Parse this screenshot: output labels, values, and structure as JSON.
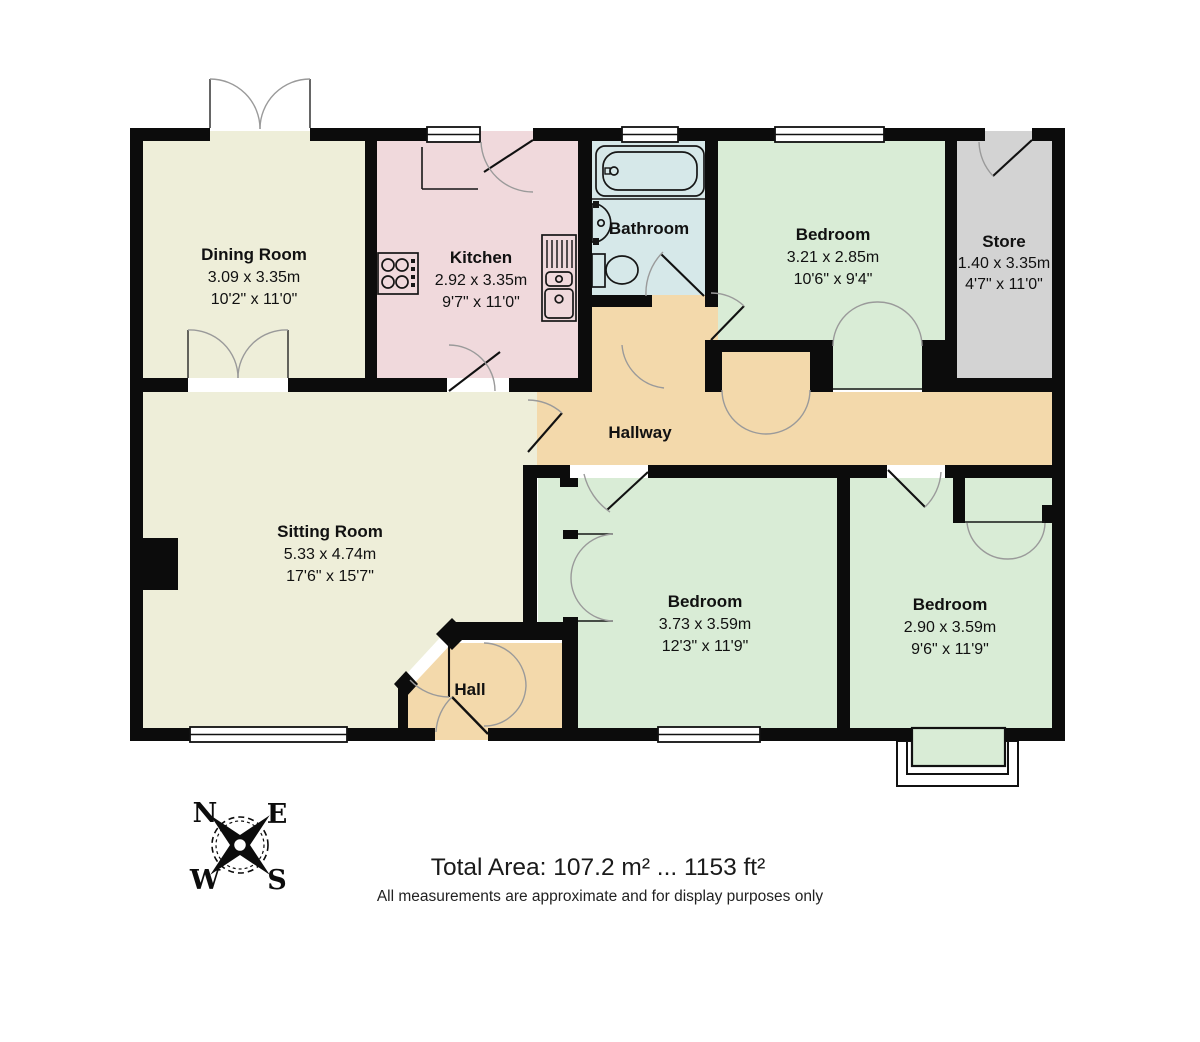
{
  "plan_title": "Bungalow floor plan",
  "rooms": [
    {
      "name": "Dining Room",
      "dim_m": "3.09 x 3.35m",
      "dim_ft": "10'2\" x 11'0\""
    },
    {
      "name": "Kitchen",
      "dim_m": "2.92 x 3.35m",
      "dim_ft": "9'7\" x 11'0\""
    },
    {
      "name": "Bathroom",
      "dim_m": "",
      "dim_ft": ""
    },
    {
      "name": "Bedroom",
      "dim_m": "3.21 x 2.85m",
      "dim_ft": "10'6\" x 9'4\""
    },
    {
      "name": "Store",
      "dim_m": "1.40 x 3.35m",
      "dim_ft": "4'7\" x 11'0\""
    },
    {
      "name": "Hallway",
      "dim_m": "",
      "dim_ft": ""
    },
    {
      "name": "Sitting Room",
      "dim_m": "5.33 x 4.74m",
      "dim_ft": "17'6\" x 15'7\""
    },
    {
      "name": "Bedroom",
      "dim_m": "3.73 x 3.59m",
      "dim_ft": "12'3\" x 11'9\""
    },
    {
      "name": "Bedroom",
      "dim_m": "2.90 x 3.59m",
      "dim_ft": "9'6\" x 11'9\""
    },
    {
      "name": "Hall",
      "dim_m": "",
      "dim_ft": ""
    }
  ],
  "compass": {
    "n": "N",
    "e": "E",
    "s": "S",
    "w": "W"
  },
  "footer": {
    "total_area": "Total Area: 107.2 m² ... 1153 ft²",
    "disclaimer": "All measurements are approximate and for display purposes only"
  },
  "colors": {
    "dining_sitting": "#eeeed9",
    "kitchen": "#f0d9dc",
    "bathroom": "#d6e8e9",
    "bedrooms": "#d9ecd6",
    "store": "#d3d3d3",
    "hallway": "#f3d9ab",
    "walls": "#0c0c0c"
  }
}
